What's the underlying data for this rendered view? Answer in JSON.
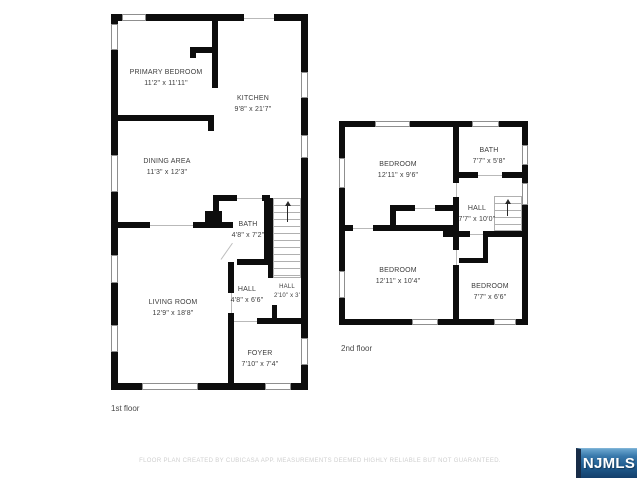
{
  "floors": [
    {
      "label": "1st floor",
      "rooms": [
        {
          "name": "PRIMARY BEDROOM",
          "dims": "11'2\" x 11'11\""
        },
        {
          "name": "KITCHEN",
          "dims": "9'8\" x 21'7\""
        },
        {
          "name": "DINING AREA",
          "dims": "11'3\" x 12'3\""
        },
        {
          "name": "BATH",
          "dims": "4'8\" x 7'2\""
        },
        {
          "name": "LIVING ROOM",
          "dims": "12'9\" x 18'8\""
        },
        {
          "name": "HALL",
          "dims": "4'8\" x 6'6\""
        },
        {
          "name": "HALL",
          "dims": "2'10\" x 3'"
        },
        {
          "name": "FOYER",
          "dims": "7'10\" x 7'4\""
        }
      ]
    },
    {
      "label": "2nd floor",
      "rooms": [
        {
          "name": "BEDROOM",
          "dims": "12'11\" x 9'6\""
        },
        {
          "name": "BATH",
          "dims": "7'7\" x 5'8\""
        },
        {
          "name": "HALL",
          "dims": "7'7\" x 10'0\""
        },
        {
          "name": "BEDROOM",
          "dims": "12'11\" x 10'4\""
        },
        {
          "name": "BEDROOM",
          "dims": "7'7\" x 6'6\""
        }
      ]
    }
  ],
  "footer": {
    "disclaimer": "FLOOR PLAN CREATED BY CUBICASA APP. MEASUREMENTS DEEMED HIGHLY RELIABLE BUT NOT GUARANTEED."
  },
  "logo": {
    "text": "NJMLS"
  },
  "colors": {
    "wall": "#0d0d0d",
    "label_text": "#3d3d3d",
    "disclaimer_text": "#cfcfcf",
    "logo_blue_top": "#6aa6cf",
    "logo_blue_bottom": "#143f6b",
    "logo_edge": "#182c47"
  }
}
